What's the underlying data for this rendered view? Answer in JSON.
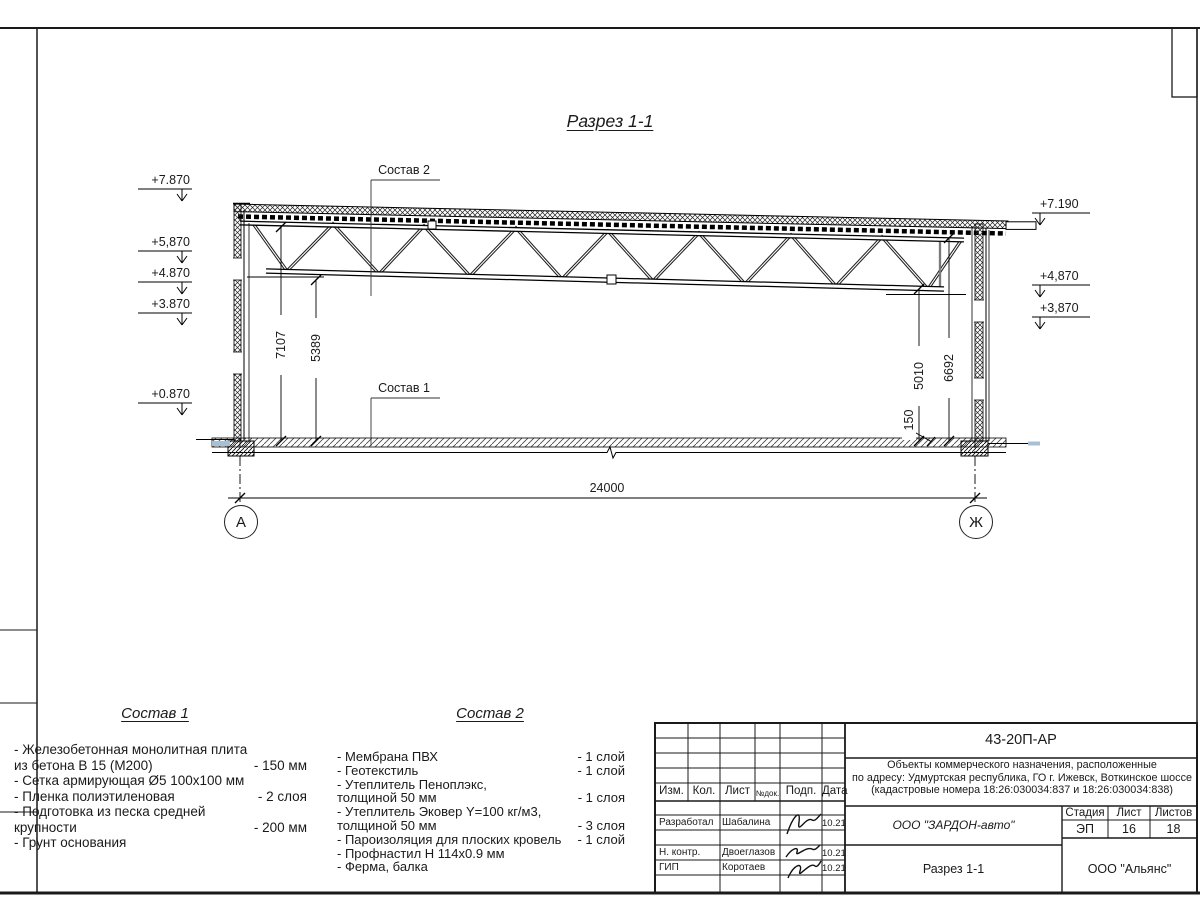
{
  "sheet": {
    "section_title": "Разрез 1-1",
    "callout_sostav1": "Состав 1",
    "callout_sostav2": "Состав 2",
    "elevations_left": [
      "+7.870",
      "+5,870",
      "+4.870",
      "+3.870",
      "+0.870"
    ],
    "elevations_right": [
      "+7.190",
      "+4,870",
      "+3,870"
    ],
    "dimensions": {
      "span": "24000",
      "left_inner": "7107",
      "left_inner2": "5389",
      "right_inner": "5010",
      "right_inner2": "6692",
      "slab": "150"
    },
    "axes": {
      "left": "А",
      "right": "Ж"
    },
    "colors": {
      "line": "#1a1a1a",
      "paper": "#ffffff",
      "apron_highlight": "#a8c0d4"
    }
  },
  "sostav1": {
    "title": "Состав 1",
    "lines": [
      {
        "text": "- Железобетонная  монолитная плита",
        "value": ""
      },
      {
        "text": "  из бетона В 15 (М200)",
        "value": "- 150 мм"
      },
      {
        "text": "- Сетка армирующая Ø5 100х100 мм",
        "value": ""
      },
      {
        "text": "- Пленка полиэтиленовая",
        "value": "-  2 слоя"
      },
      {
        "text": "- Подготовка из песка средней",
        "value": ""
      },
      {
        "text": "  крупности",
        "value": "- 200 мм"
      },
      {
        "text": "- Грунт основания",
        "value": ""
      }
    ]
  },
  "sostav2": {
    "title": "Состав 2",
    "lines": [
      {
        "text": "- Мембрана ПВХ",
        "value": "- 1 слой"
      },
      {
        "text": "- Геотекстиль",
        "value": "- 1 слой"
      },
      {
        "text": "- Утеплитель Пеноплэкс,",
        "value": ""
      },
      {
        "text": "  толщиной 50 мм",
        "value": "- 1 слоя"
      },
      {
        "text": "- Утеплитель Эковер Y=100 кг/м3,",
        "value": ""
      },
      {
        "text": "  толщиной 50 мм",
        "value": "- 3 слоя"
      },
      {
        "text": "- Пароизоляция для плоских кровель",
        "value": "- 1 слой"
      },
      {
        "text": "- Профнастил Н 114х0.9 мм",
        "value": ""
      },
      {
        "text": "- Ферма, балка",
        "value": ""
      }
    ]
  },
  "titleblock": {
    "doc_number": "43-20П-АР",
    "project": {
      "line1": "Объекты коммерческого назначения, расположенные",
      "line2": "по адресу: Удмуртская республика, ГО г. Ижевск, Воткинское шоссе",
      "line3": "(кадастровые номера 18:26:030034:837 и 18:26:030034:838)"
    },
    "columns": {
      "izm": "Изм.",
      "kol": "Кол.",
      "list": "Лист",
      "ndok": "№док.",
      "podp": "Подп.",
      "data": "Дата"
    },
    "signers": [
      {
        "role": "Разработал",
        "name": "Шабалина",
        "date": "10.21"
      },
      {
        "role": "Н. контр.",
        "name": "Двоеглазов",
        "date": "10.21"
      },
      {
        "role": "ГИП",
        "name": "Коротаев",
        "date": "10.21"
      }
    ],
    "developer": "ООО \"ЗАРДОН-авто\"",
    "sheet_name": "Разрез 1-1",
    "stage_label": "Стадия",
    "sheet_label": "Лист",
    "sheets_label": "Листов",
    "stage": "ЭП",
    "sheet_no": "16",
    "sheets_total": "18",
    "org": "ООО \"Альянс\""
  }
}
